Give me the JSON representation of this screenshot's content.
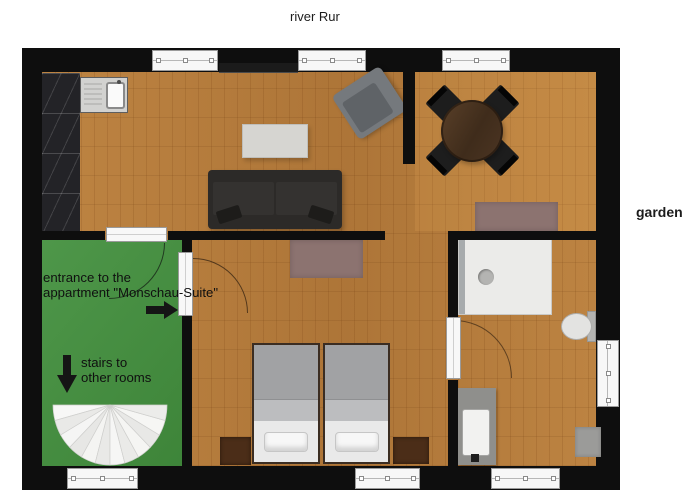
{
  "labels": {
    "river": "river Rur",
    "garden": "garden"
  },
  "annotations": {
    "entrance_line1": "entrance to the",
    "entrance_line2": "appartment \"Monschau-Suite\"",
    "stairs_line1": "stairs to",
    "stairs_line2": "other rooms"
  },
  "colors": {
    "wall": "#0e0e0e",
    "wood_floor": "#b67c3c",
    "entrance_room_green": "#43903e",
    "rug_mauve": "#8c7370",
    "kitchen_counter": "#232327",
    "sofa": "#2c2a28",
    "coffee_table": "#d6d5d1",
    "armchair": "#75797d",
    "dining_table": "#4c3523",
    "dining_chair": "#1d1d1d",
    "bed_blanket": "#a1a2a4",
    "bed_sheet": "#e9e9e9",
    "nightstand": "#4b2d18",
    "shower": "#ebebe9",
    "vanity": "#8f8f8c",
    "window": "#f7f7f7",
    "staircase": "#f1f1ef"
  },
  "floor_plan": {
    "rooms": [
      "open kitchen / living / dining room",
      "entrance stairwell",
      "bedroom",
      "bathroom"
    ],
    "furniture": [
      "kitchen counter",
      "kitchen sink",
      "tv lowboard",
      "sofa",
      "coffee table",
      "armchair",
      "round dining table",
      "4 dining chairs",
      "2 rugs",
      "2 single beds with pillows",
      "2 nightstands",
      "shower",
      "toilet",
      "vanity sink",
      "bath mat",
      "spiral staircase"
    ],
    "window_count": 7,
    "door_count": 3
  }
}
